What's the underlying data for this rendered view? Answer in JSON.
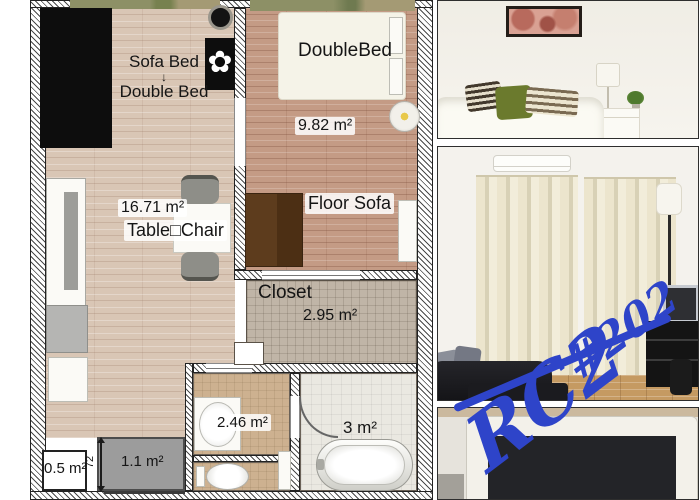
{
  "floorplan": {
    "living": {
      "sofa_bed": "Sofa Bed",
      "arrow": "↓",
      "double_bed": "Double Bed",
      "area": "16.71 m²",
      "table_chair": "Table□Chair"
    },
    "bedroom": {
      "bed_label": "DoubleBed",
      "area": "9.82 m²",
      "floor_sofa": "Floor Sofa"
    },
    "closet": {
      "label": "Closet",
      "area": "2.95 m²"
    },
    "washroom": {
      "area": "2.46 m²"
    },
    "bath": {
      "area": "3 m²"
    },
    "storage": {
      "area": "0.5 m²"
    },
    "entrance": {
      "area": "1.1 m²",
      "width": "72"
    }
  },
  "annotation": {
    "code": "RC2",
    "unit": "#202",
    "color": "#2e44c9"
  }
}
